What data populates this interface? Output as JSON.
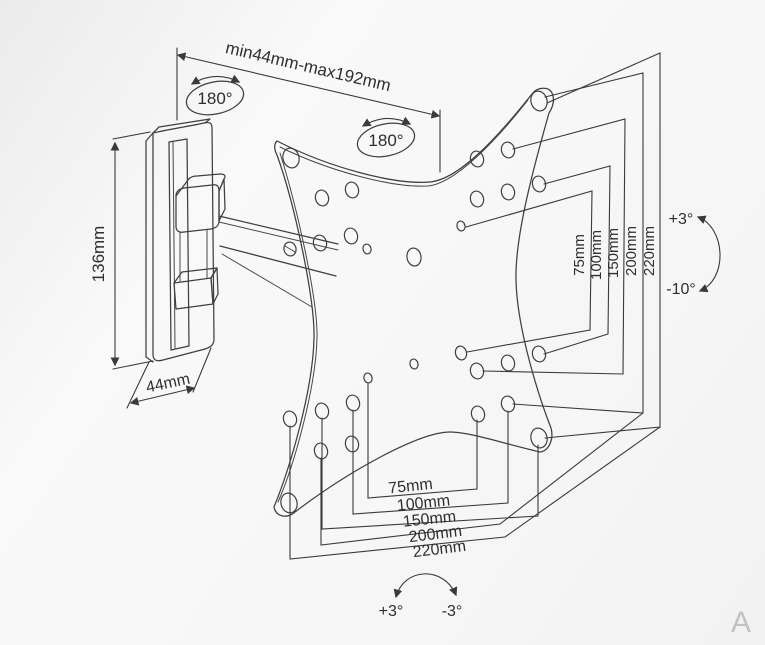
{
  "page": {
    "watermark": "A"
  },
  "labels": {
    "arm_extension": "min44mm-max192mm",
    "swivel_wall": "180°",
    "swivel_plate": "180°",
    "wall_plate_height": "136mm",
    "wall_plate_width": "44mm",
    "vesa_vertical": [
      "75mm",
      "100mm",
      "150mm",
      "200mm",
      "220mm"
    ],
    "vesa_horizontal": [
      "75mm",
      "100mm",
      "150mm",
      "200mm",
      "220mm"
    ],
    "tilt_up": "+3°",
    "tilt_down": "-10°",
    "level_left": "+3°",
    "level_right": "-3°"
  },
  "colors": {
    "line": "#3f3f3f",
    "text": "#2e2e2e",
    "watermark": "#c2c2c2"
  }
}
